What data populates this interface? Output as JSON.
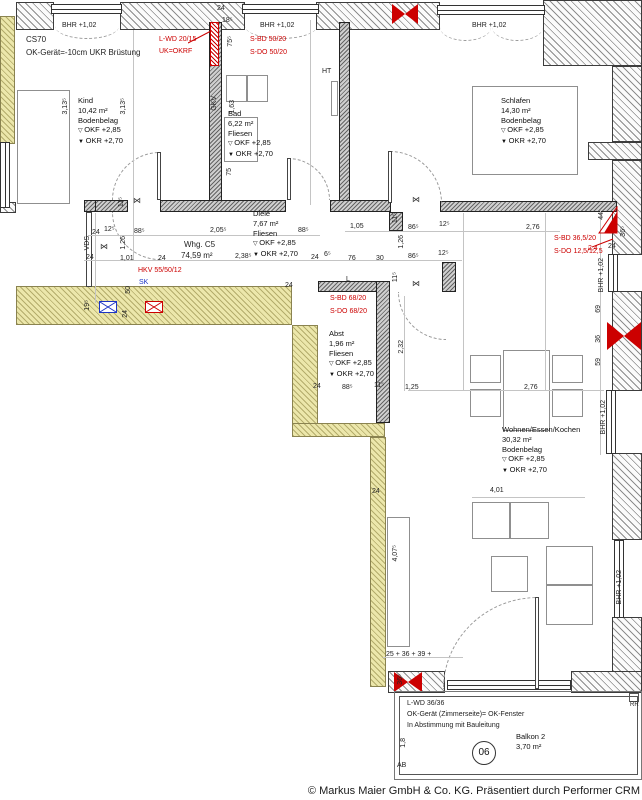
{
  "footer": {
    "copyright": "© Markus Maier GmbH & Co. KG. Präsentiert durch Performer CRM"
  },
  "apartment": {
    "name": "Whg. C5",
    "area": "74,59 m²"
  },
  "balcony": {
    "note1": "L-WD 36/36",
    "note2": "OK-Gerät (Zimmerseite)= OK-Fenster",
    "note3": "In Abstimmung mit Bauleitung",
    "position_number": "06",
    "ab_label": "AB",
    "rr_label": "RR",
    "dim_18": "1,8"
  },
  "rooms": [
    {
      "id": "kind",
      "name": "Kind",
      "area": "10,42 m²",
      "floor": "Bodenbelag",
      "okf": "OKF  +2,85",
      "okr": "OKR  +2,70",
      "x": 78,
      "y": 96
    },
    {
      "id": "bad",
      "name": "Bad",
      "area": "6,22 m²",
      "floor": "Fliesen",
      "okf": "OKF  +2,85",
      "okr": "OKR  +2,70",
      "x": 228,
      "y": 109
    },
    {
      "id": "schlafen",
      "name": "Schlafen",
      "area": "14,30 m²",
      "floor": "Bodenbelag",
      "okf": "OKF  +2,85",
      "okr": "OKR  +2,70",
      "x": 501,
      "y": 96
    },
    {
      "id": "diele",
      "name": "Diele",
      "area": "7,67 m²",
      "floor": "Fliesen",
      "okf": "OKF  +2,85",
      "okr": "OKR  +2,70",
      "x": 253,
      "y": 209
    },
    {
      "id": "abst",
      "name": "Abst",
      "area": "1,96 m²",
      "floor": "Fliesen",
      "okf": "OKF  +2,85",
      "okr": "OKR  +2,70",
      "x": 329,
      "y": 329
    },
    {
      "id": "wohnen",
      "name": "Wohnen/Essen/Kochen",
      "area": "30,32 m²",
      "floor": "Bodenbelag",
      "okf": "OKF  +2,85",
      "okr": "OKR  +2,70",
      "x": 502,
      "y": 425
    },
    {
      "id": "balkon",
      "name": "Balkon 2",
      "area": "3,70 m²",
      "x": 516,
      "y": 732
    }
  ],
  "texts": [
    {
      "t": "CS70",
      "x": 26,
      "y": 36,
      "s": 1
    },
    {
      "t": "OK-Gerät=-10cm UKR Brüstung",
      "x": 26,
      "y": 49,
      "s": 1
    },
    {
      "t": "Whg. C5",
      "x": 184,
      "y": 241,
      "s": 1
    },
    {
      "t": "74,59 m²",
      "x": 181,
      "y": 252,
      "s": 1
    },
    {
      "t": "BHR +1,02",
      "x": 62,
      "y": 22
    },
    {
      "t": "BHR +1,02",
      "x": 260,
      "y": 22
    },
    {
      "t": "BHR +1,02",
      "x": 472,
      "y": 22
    },
    {
      "t": "BHR +1,02",
      "x": 598,
      "y": 258,
      "r": 1
    },
    {
      "t": "BHR +1,02",
      "x": 600,
      "y": 400,
      "r": 1
    },
    {
      "t": "BHR +1,02",
      "x": 616,
      "y": 570,
      "r": 1
    },
    {
      "t": "L-WD 20/15",
      "x": 159,
      "y": 36,
      "c": "red"
    },
    {
      "t": "UK=OKRF",
      "x": 159,
      "y": 48,
      "c": "red"
    },
    {
      "t": "S-BD 50/20",
      "x": 250,
      "y": 36,
      "c": "red"
    },
    {
      "t": "S-DO 50/20",
      "x": 250,
      "y": 49,
      "c": "red"
    },
    {
      "t": "S-BD 36,5/20",
      "x": 554,
      "y": 235,
      "c": "red"
    },
    {
      "t": "S-DO 12,5/12,5",
      "x": 554,
      "y": 248,
      "c": "red"
    },
    {
      "t": "2,4",
      "x": 588,
      "y": 245,
      "c": "red"
    },
    {
      "t": "S-BD 68/20",
      "x": 330,
      "y": 295,
      "c": "red"
    },
    {
      "t": "S-DO 68/20",
      "x": 330,
      "y": 308,
      "c": "red"
    },
    {
      "t": "HKV 55/50/12",
      "x": 138,
      "y": 267,
      "c": "red"
    },
    {
      "t": "SK",
      "x": 139,
      "y": 279,
      "c": "blue"
    },
    {
      "t": "HT",
      "x": 322,
      "y": 68
    },
    {
      "t": "GKV",
      "x": 211,
      "y": 96,
      "r": 1
    },
    {
      "t": "L",
      "x": 346,
      "y": 276
    },
    {
      "t": "VDS",
      "x": 84,
      "y": 236,
      "r": 1
    },
    {
      "t": "24",
      "x": 217,
      "y": 5
    },
    {
      "t": "18⁵",
      "x": 222,
      "y": 17
    },
    {
      "t": "75⁵",
      "x": 227,
      "y": 36,
      "r": 1
    },
    {
      "t": "1,63",
      "x": 229,
      "y": 100,
      "r": 1
    },
    {
      "t": "3,13⁵",
      "x": 62,
      "y": 98,
      "r": 1
    },
    {
      "t": "3,13⁵",
      "x": 120,
      "y": 98,
      "r": 1
    },
    {
      "t": "75",
      "x": 226,
      "y": 168,
      "r": 1
    },
    {
      "t": "11⁵",
      "x": 118,
      "y": 197,
      "r": 1
    },
    {
      "t": "24",
      "x": 92,
      "y": 229
    },
    {
      "t": "12⁵",
      "x": 104,
      "y": 226
    },
    {
      "t": "88⁵",
      "x": 134,
      "y": 228
    },
    {
      "t": "2,05⁵",
      "x": 210,
      "y": 227
    },
    {
      "t": "88⁵",
      "x": 298,
      "y": 227
    },
    {
      "t": "1,26",
      "x": 120,
      "y": 236,
      "r": 1
    },
    {
      "t": "24",
      "x": 86,
      "y": 254
    },
    {
      "t": "1,01",
      "x": 120,
      "y": 255
    },
    {
      "t": "24",
      "x": 158,
      "y": 255
    },
    {
      "t": "2,38⁵",
      "x": 235,
      "y": 253
    },
    {
      "t": "24",
      "x": 311,
      "y": 254
    },
    {
      "t": "6⁵",
      "x": 324,
      "y": 251
    },
    {
      "t": "76",
      "x": 348,
      "y": 255
    },
    {
      "t": "30",
      "x": 376,
      "y": 255
    },
    {
      "t": "86⁵",
      "x": 408,
      "y": 253
    },
    {
      "t": "12⁵",
      "x": 438,
      "y": 250
    },
    {
      "t": "1,05",
      "x": 350,
      "y": 223
    },
    {
      "t": "86⁵",
      "x": 408,
      "y": 224
    },
    {
      "t": "12⁵",
      "x": 439,
      "y": 221
    },
    {
      "t": "1,26",
      "x": 398,
      "y": 235,
      "r": 1
    },
    {
      "t": "11⁵",
      "x": 392,
      "y": 213,
      "r": 1
    },
    {
      "t": "11⁵",
      "x": 392,
      "y": 272,
      "r": 1
    },
    {
      "t": "2,76",
      "x": 526,
      "y": 224
    },
    {
      "t": "24",
      "x": 608,
      "y": 243
    },
    {
      "t": "36⁵",
      "x": 620,
      "y": 226,
      "r": 1
    },
    {
      "t": "44",
      "x": 598,
      "y": 212,
      "r": 1
    },
    {
      "t": "69",
      "x": 595,
      "y": 305,
      "r": 1
    },
    {
      "t": "36",
      "x": 595,
      "y": 335,
      "r": 1
    },
    {
      "t": "59",
      "x": 595,
      "y": 358,
      "r": 1
    },
    {
      "t": "50",
      "x": 125,
      "y": 286,
      "r": 1
    },
    {
      "t": "24",
      "x": 122,
      "y": 310,
      "r": 1
    },
    {
      "t": "19⁵",
      "x": 84,
      "y": 300,
      "r": 1
    },
    {
      "t": "24",
      "x": 285,
      "y": 282
    },
    {
      "t": "24",
      "x": 313,
      "y": 383
    },
    {
      "t": "88⁵",
      "x": 342,
      "y": 384
    },
    {
      "t": "11⁵",
      "x": 374,
      "y": 382
    },
    {
      "t": "1,25",
      "x": 405,
      "y": 384
    },
    {
      "t": "2,76",
      "x": 524,
      "y": 384
    },
    {
      "t": "2,32",
      "x": 398,
      "y": 340,
      "r": 1
    },
    {
      "t": "24",
      "x": 372,
      "y": 488
    },
    {
      "t": "4,01",
      "x": 490,
      "y": 487
    },
    {
      "t": "4,07⁵",
      "x": 392,
      "y": 545,
      "r": 1
    },
    {
      "t": "25 + 36 + 39 +",
      "x": 386,
      "y": 651
    },
    {
      "t": "36⁵",
      "x": 397,
      "y": 674,
      "r": 1
    },
    {
      "t": "⋈",
      "x": 133,
      "y": 197,
      "c": "bt"
    },
    {
      "t": "⋈",
      "x": 412,
      "y": 196,
      "c": "bt"
    },
    {
      "t": "⋈",
      "x": 412,
      "y": 280,
      "c": "bt"
    },
    {
      "t": "⋈",
      "x": 100,
      "y": 243,
      "c": "bt"
    }
  ]
}
